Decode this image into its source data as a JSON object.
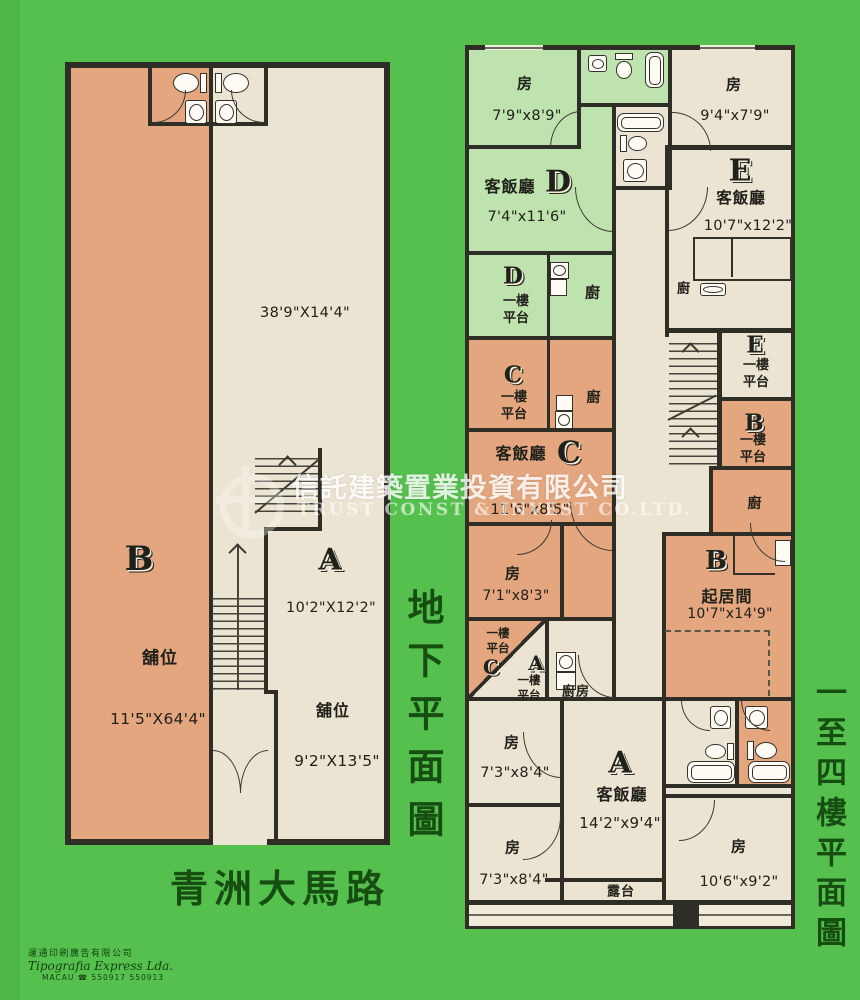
{
  "watermark": {
    "company_cn": "信託建築置業投資有限公司",
    "company_en": "TRUST CONST & INVEST CO.LTD."
  },
  "ground_plan": {
    "side_title": "地下平面圖",
    "street_name": "青洲大馬路",
    "hall_dim": "38'9\"X14'4\"",
    "unit_b": {
      "letter": "B",
      "shop_label": "舖位",
      "dim": "11'5\"X64'4\""
    },
    "unit_a": {
      "letter": "A",
      "upper_dim": "10'2\"X12'2\"",
      "shop_label": "舖位",
      "lower_dim": "9'2\"X13'5\""
    }
  },
  "upper_plan": {
    "side_title": "一至四樓平面圖",
    "unit_d": {
      "letter": "D",
      "bedroom_label": "房",
      "bedroom_dim": "7'9\"x8'9\"",
      "living_label": "客飯廳",
      "living_dim": "7'4\"x11'6\"",
      "kitchen_label": "廚",
      "terrace_label": "一樓平台"
    },
    "unit_e": {
      "letter": "E",
      "bedroom_label": "房",
      "bedroom_dim": "9'4\"x7'9\"",
      "living_label": "客飯廳",
      "living_dim": "10'7\"x12'2\"",
      "kitchen_label": "廚",
      "terrace_label": "一樓平台"
    },
    "unit_c": {
      "letter": "C",
      "living_label": "客飯廳",
      "living_dim": "11'6\"x8'5\"",
      "bedroom_label": "房",
      "bedroom_dim": "7'1\"x8'3\"",
      "kitchen_label": "廚",
      "terrace_label": "一樓平台"
    },
    "unit_b": {
      "letter": "B",
      "living_label": "起居間",
      "living_dim": "10'7\"x14'9\"",
      "kitchen_label": "廚",
      "terrace_label": "一樓平台"
    },
    "unit_a": {
      "letter": "A",
      "living_label": "客飯廳",
      "living_dim": "14'2\"x9'4\"",
      "kitchen_label": "廚房",
      "terrace_label": "一樓平台",
      "bedroom1_label": "房",
      "bedroom1_dim": "7'3\"x8'4\"",
      "bedroom2_label": "房",
      "bedroom2_dim": "7'3\"x8'4\"",
      "bedroom3_label": "房",
      "bedroom3_dim": "10'6\"x9'2\"",
      "balcony_label": "露台"
    }
  },
  "printer": {
    "line1": "運通印刷廣告有限公司",
    "line2": "Tipografia Express Lda.",
    "line3": "MACAU ☎ 550917 550913"
  },
  "colors": {
    "background_green": "#55c04d",
    "shop_orange": "#e3a67e",
    "floor_cream": "#ece4d2",
    "unit_d_green": "#bfe3ae",
    "wall_dark": "#2e2e27",
    "title_green": "#164e12",
    "watermark_white": "#ffffff"
  }
}
